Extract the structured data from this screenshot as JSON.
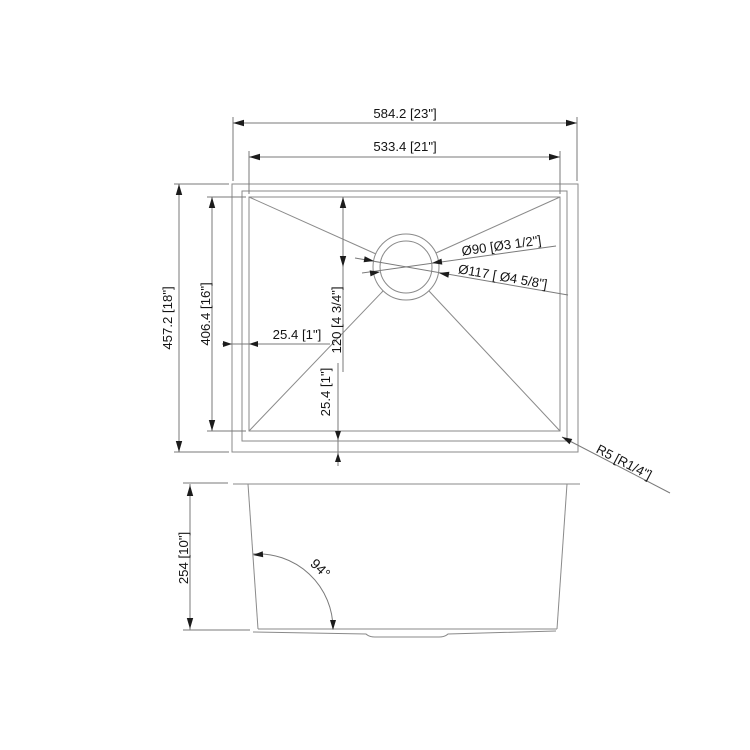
{
  "drawing": {
    "type": "technical-dimension-drawing",
    "subject": "undermount-single-bowl-sink",
    "background_color": "#ffffff",
    "object_line_color": "#8a8a8a",
    "dimension_line_color": "#7a7a7a",
    "arrow_color": "#1c1c1c",
    "text_color": "#141414",
    "top_view": {
      "overall_width_label": "584.2  [23\"]",
      "bowl_width_label": "533.4 [21\"]",
      "overall_depth_label": "457.2 [18\"]",
      "bowl_depth_label": "406.4 [16\"]",
      "rim_reveal_left_label": "25.4 [1\"]",
      "rim_reveal_bottom_label": "25.4 [1\"]",
      "drain_offset_label": "120 [4 3/4\"]",
      "drain_inner_diameter_label": "Ø90 [Ø3 1/2\"]",
      "drain_outer_diameter_label": "Ø117 [ Ø4 5/8\"]",
      "corner_radius_label": "R5 [R1/4\"]"
    },
    "side_view": {
      "bowl_depth_label": "254 [10\"]",
      "wall_angle_label": "94°"
    }
  }
}
